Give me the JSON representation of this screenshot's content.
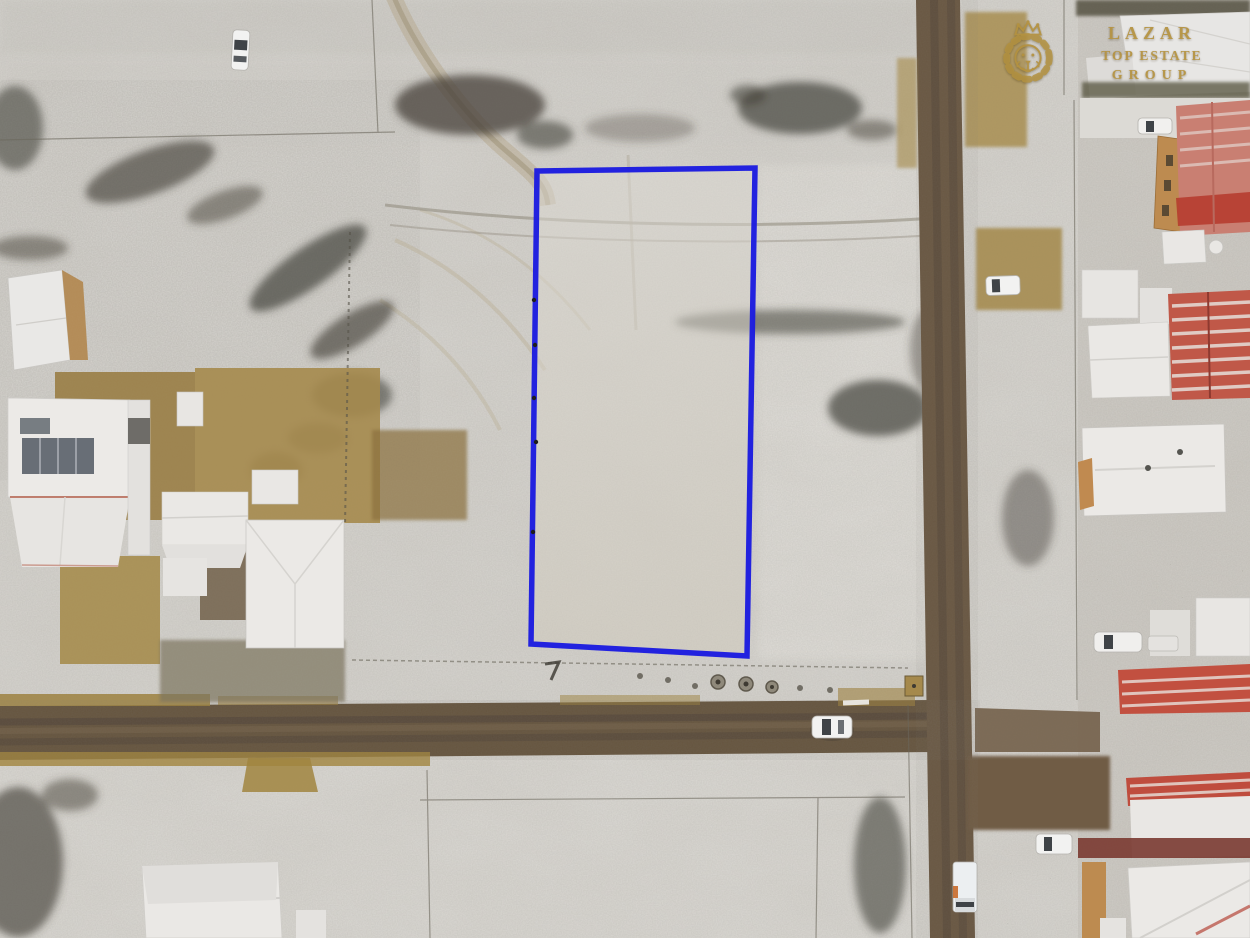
{
  "photo": {
    "kind": "aerial drone photograph, top-down",
    "scene": "snow-dusted village: vacant land plot outlined in blue, two dirt roads crossing, houses with snow-covered white roofs on the left and red/white roofs on the right"
  },
  "watermark": {
    "icon": "crowned-lion-icon",
    "lines": [
      "LAZAR",
      "TOP ESTATE",
      "GROUP"
    ],
    "color": "#b3913f"
  },
  "plot_outline": {
    "shape": "quadrilateral",
    "points": "537,171 755,168 747,656 531,644",
    "color": "#1b1be0",
    "stroke_width": 5.5
  },
  "palette": {
    "snow": "#dcdad5",
    "shaded_snow": "#d7d5d0",
    "dirt_road": "#66553f",
    "bare_soil": "#a5894c",
    "white_roof": "#ebe9e6",
    "red_roof": "#c05848",
    "dark_red_wall": "#7a3a31",
    "orange_wall": "#bd8b50",
    "vegetation": "#45423a"
  },
  "vehicles": [
    "white car parked in field top-left",
    "white car parked beside right street",
    "white car on main road",
    "white car parked bottom-right",
    "white truck parked on right street",
    "white car in right-side yard",
    "white car in upper-right yard"
  ]
}
